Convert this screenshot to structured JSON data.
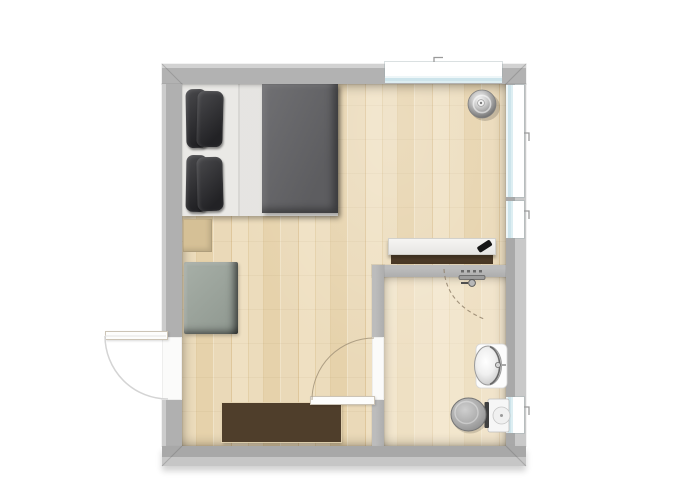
{
  "scene": {
    "description": "Top-down floor plan of a studio apartment with a bedroom area and an en-suite bathroom",
    "type": "floor-plan"
  },
  "rooms": [
    {
      "id": "bedroom",
      "label": "Bedroom and living area with wood floor"
    },
    {
      "id": "bathroom",
      "label": "Bathroom"
    }
  ],
  "doors": [
    {
      "id": "entry-door",
      "label": "Entry door on left wall swinging outward"
    },
    {
      "id": "bathroom-door",
      "label": "Bathroom door swinging into the room"
    }
  ],
  "windows": [
    {
      "id": "window-top",
      "label": "Window in top wall"
    },
    {
      "id": "window-right-upper",
      "label": "Upper window in right wall"
    },
    {
      "id": "window-right-lower",
      "label": "Lower window in right wall"
    },
    {
      "id": "window-bathroom",
      "label": "Bathroom window in right wall"
    }
  ],
  "furniture": [
    {
      "id": "double-bed",
      "label": "Double bed with grey duvet and dark pillows"
    },
    {
      "id": "bedside-mat",
      "label": "Bedside mat at foot of bed"
    },
    {
      "id": "armchair",
      "label": "Grey-green armchair against left wall"
    },
    {
      "id": "sideboard",
      "label": "Dark brown sideboard against bottom wall"
    },
    {
      "id": "desk",
      "label": "White desk on bathroom partition wall"
    },
    {
      "id": "laptop",
      "label": "Black laptop on desk"
    },
    {
      "id": "floor-lamp",
      "label": "Round floor lamp in top right corner"
    },
    {
      "id": "shower-mixer",
      "label": "Shower mixer tap on bathroom wall"
    },
    {
      "id": "wash-basin",
      "label": "Oval wash basin with counter"
    },
    {
      "id": "toilet",
      "label": "Toilet with cistern"
    }
  ],
  "colors": {
    "background": "#ffffff",
    "wall": "#b2b2b2",
    "wall_highlight": "#d2d2d2",
    "floor_wood": "#e8d6b2",
    "floor_bathroom": "#efe3c9",
    "window_glass": "#d6e9ee",
    "window_frame": "#ffffff",
    "duvet": "#646467",
    "pillows": "#2f2f32",
    "bed_linen": "#eae9e6",
    "armchair": "#9ba39c",
    "sideboard": "#4f3e2b",
    "desk": "#f3f2f0",
    "desk_edge": "#513f2a",
    "laptop": "#191919",
    "toilet_seat": "#a4a4a4",
    "ceramic_white": "#f7f7f7"
  }
}
